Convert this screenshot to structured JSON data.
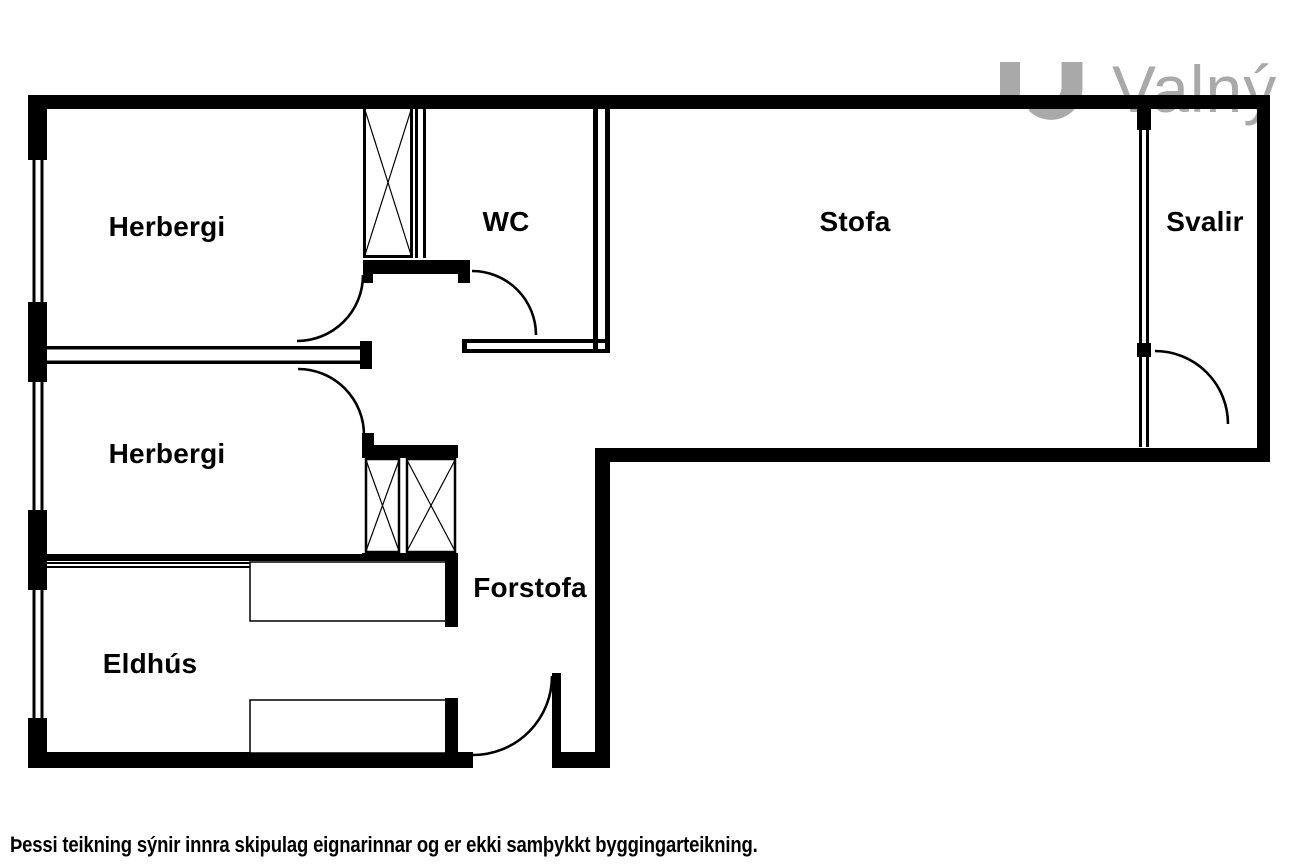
{
  "floorplan": {
    "rooms": [
      {
        "id": "herbergi-1",
        "label": "Herbergi"
      },
      {
        "id": "wc",
        "label": "WC"
      },
      {
        "id": "stofa",
        "label": "Stofa"
      },
      {
        "id": "svalir",
        "label": "Svalir"
      },
      {
        "id": "herbergi-2",
        "label": "Herbergi"
      },
      {
        "id": "forstofa",
        "label": "Forstofa"
      },
      {
        "id": "eldhus",
        "label": "Eldhús"
      }
    ],
    "symbols": [
      "wardrobe-x",
      "door-swing-arc",
      "window-double-line",
      "kitchen-counter"
    ]
  },
  "logo": {
    "text": "Valný"
  },
  "disclaimer": "Þessi teikning sýnir innra skipulag eignarinnar og er ekki samþykkt byggingarteikning.",
  "colors": {
    "wall": "#000000",
    "logo_gray": "#a9a9a9",
    "background": "#ffffff"
  }
}
